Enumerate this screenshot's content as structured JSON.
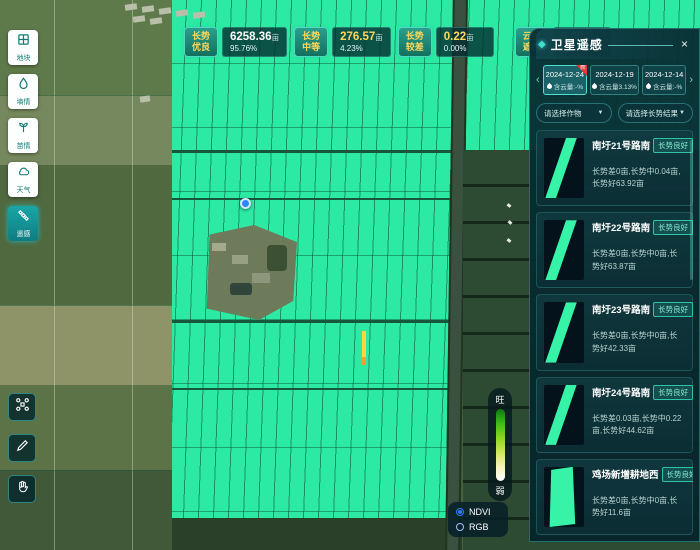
{
  "sidebar": {
    "items": [
      {
        "label": "地块",
        "icon": "plot-grid-icon"
      },
      {
        "label": "墒情",
        "icon": "droplet-icon"
      },
      {
        "label": "苗情",
        "icon": "seedling-icon"
      },
      {
        "label": "天气",
        "icon": "weather-icon"
      },
      {
        "label": "遥感",
        "icon": "satellite-icon",
        "active": true
      }
    ],
    "tools": [
      {
        "icon": "drone-icon"
      },
      {
        "icon": "pencil-icon"
      },
      {
        "icon": "hand-icon"
      }
    ]
  },
  "stats": [
    {
      "badge": "长势优良",
      "value": "6258.36",
      "unit": "亩",
      "percent": "95.76%"
    },
    {
      "badge": "长势中等",
      "value": "276.57",
      "unit": "亩",
      "percent": "4.23%"
    },
    {
      "badge": "长势较差",
      "value": "0.22",
      "unit": "亩",
      "percent": "0.00%"
    },
    {
      "badge": "云层遮挡",
      "value": "0.00",
      "unit": "亩",
      "percent": "0%"
    }
  ],
  "panel": {
    "title": "卫星遥感",
    "close": "×",
    "prev": "‹",
    "next": "›",
    "new_badge": "新",
    "dates": [
      {
        "date": "2024-12-24",
        "cloud": "含云量:-%",
        "selected": true,
        "new": true
      },
      {
        "date": "2024-12-19",
        "cloud": "含云量3.13%"
      },
      {
        "date": "2024-12-14",
        "cloud": "含云量:-%"
      }
    ],
    "filters": [
      {
        "label": "请选择作物",
        "caret": "▼"
      },
      {
        "label": "请选择长势结果",
        "caret": "▼"
      }
    ],
    "list": [
      {
        "title": "南圩21号路南",
        "badge": "长势良好",
        "desc": "长势差0亩,长势中0.04亩,长势好63.92亩"
      },
      {
        "title": "南圩22号路南",
        "badge": "长势良好",
        "desc": "长势差0亩,长势中0亩,长势好63.87亩"
      },
      {
        "title": "南圩23号路南",
        "badge": "长势良好",
        "desc": "长势差0亩,长势中0亩,长势好42.33亩"
      },
      {
        "title": "南圩24号路南",
        "badge": "长势良好",
        "desc": "长势差0.03亩,长势中0.22亩,长势好44.62亩"
      },
      {
        "title": "鸡场新增耕地西",
        "badge": "长势良好",
        "desc": "长势差0亩,长势中0亩,长势好11.6亩"
      }
    ]
  },
  "legend": {
    "top": "旺",
    "bottom": "弱"
  },
  "layer_toggle": {
    "options": [
      {
        "label": "NDVI",
        "selected": true
      },
      {
        "label": "RGB",
        "selected": false
      }
    ]
  },
  "colors": {
    "healthy_field": "#2ceaa3",
    "accent_teal": "#2fd0c0",
    "badge_yellow": "#ffd95c",
    "ndvi_blue": "#2f7bff",
    "weak_warning": "#ffd53e"
  }
}
